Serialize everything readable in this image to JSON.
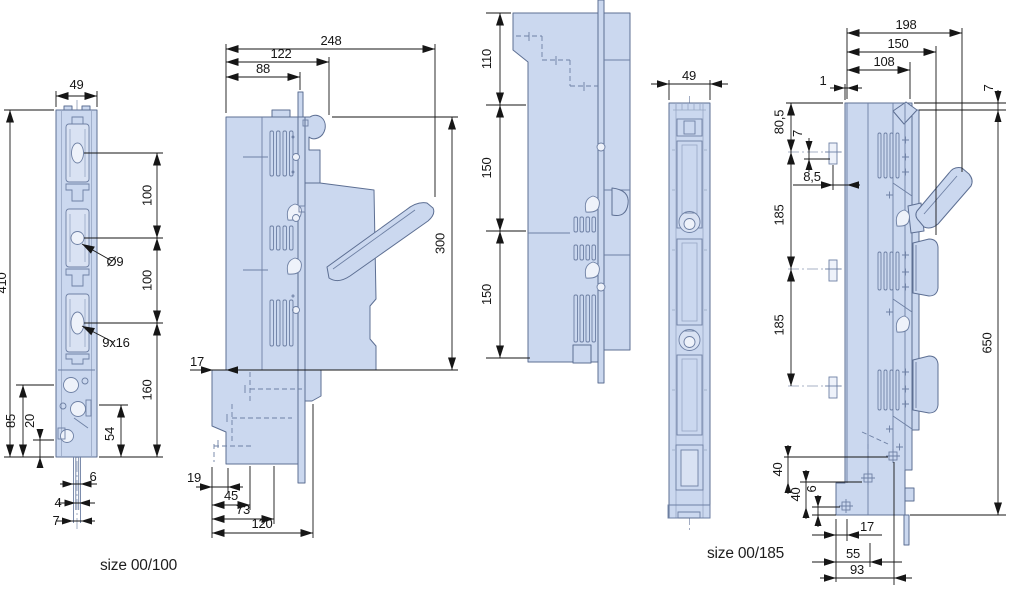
{
  "drawing": {
    "product_labels": {
      "size_00_100": "size 00/100",
      "size_00_185": "size 00/185"
    },
    "palette": {
      "body_fill": "#cbd8ef",
      "body_stroke": "#5d6f93",
      "dimension_color": "#161616",
      "background": "#ffffff"
    },
    "views": {
      "front_00_100": {
        "dims": {
          "width": "49",
          "height": "410",
          "pitch_upper": "100",
          "pitch_lower": "100",
          "lower_section": "160",
          "hole_diameter": "Ø9",
          "slot": "9x16",
          "d85": "85",
          "d20": "20",
          "d54": "54",
          "d6": "6",
          "d4": "4",
          "d7": "7"
        }
      },
      "side_00_100": {
        "dims": {
          "d248": "248",
          "d122": "122",
          "d88": "88",
          "d300": "300",
          "d17": "17",
          "d19": "19",
          "d45": "45",
          "d73": "73",
          "d120": "120"
        }
      },
      "rear_00_100": {
        "dims": {
          "d110": "110",
          "d150_upper": "150",
          "d150_lower": "150"
        }
      },
      "front_00_185": {
        "dims": {
          "width": "49"
        }
      },
      "side_00_185": {
        "dims": {
          "d198": "198",
          "d150": "150",
          "d108": "108",
          "d1": "1",
          "d7_top": "7",
          "d80_5": "80,5",
          "d7_terminal": "7",
          "d8_5": "8,5",
          "terminal_1": "L1",
          "terminal_2": "L2",
          "terminal_3": "L3",
          "d185_upper": "185",
          "d185_lower": "185",
          "d650": "650",
          "d40_upper": "40",
          "d40_lower": "40",
          "d6": "6",
          "d17": "17",
          "d55": "55",
          "d93": "93"
        }
      }
    }
  }
}
